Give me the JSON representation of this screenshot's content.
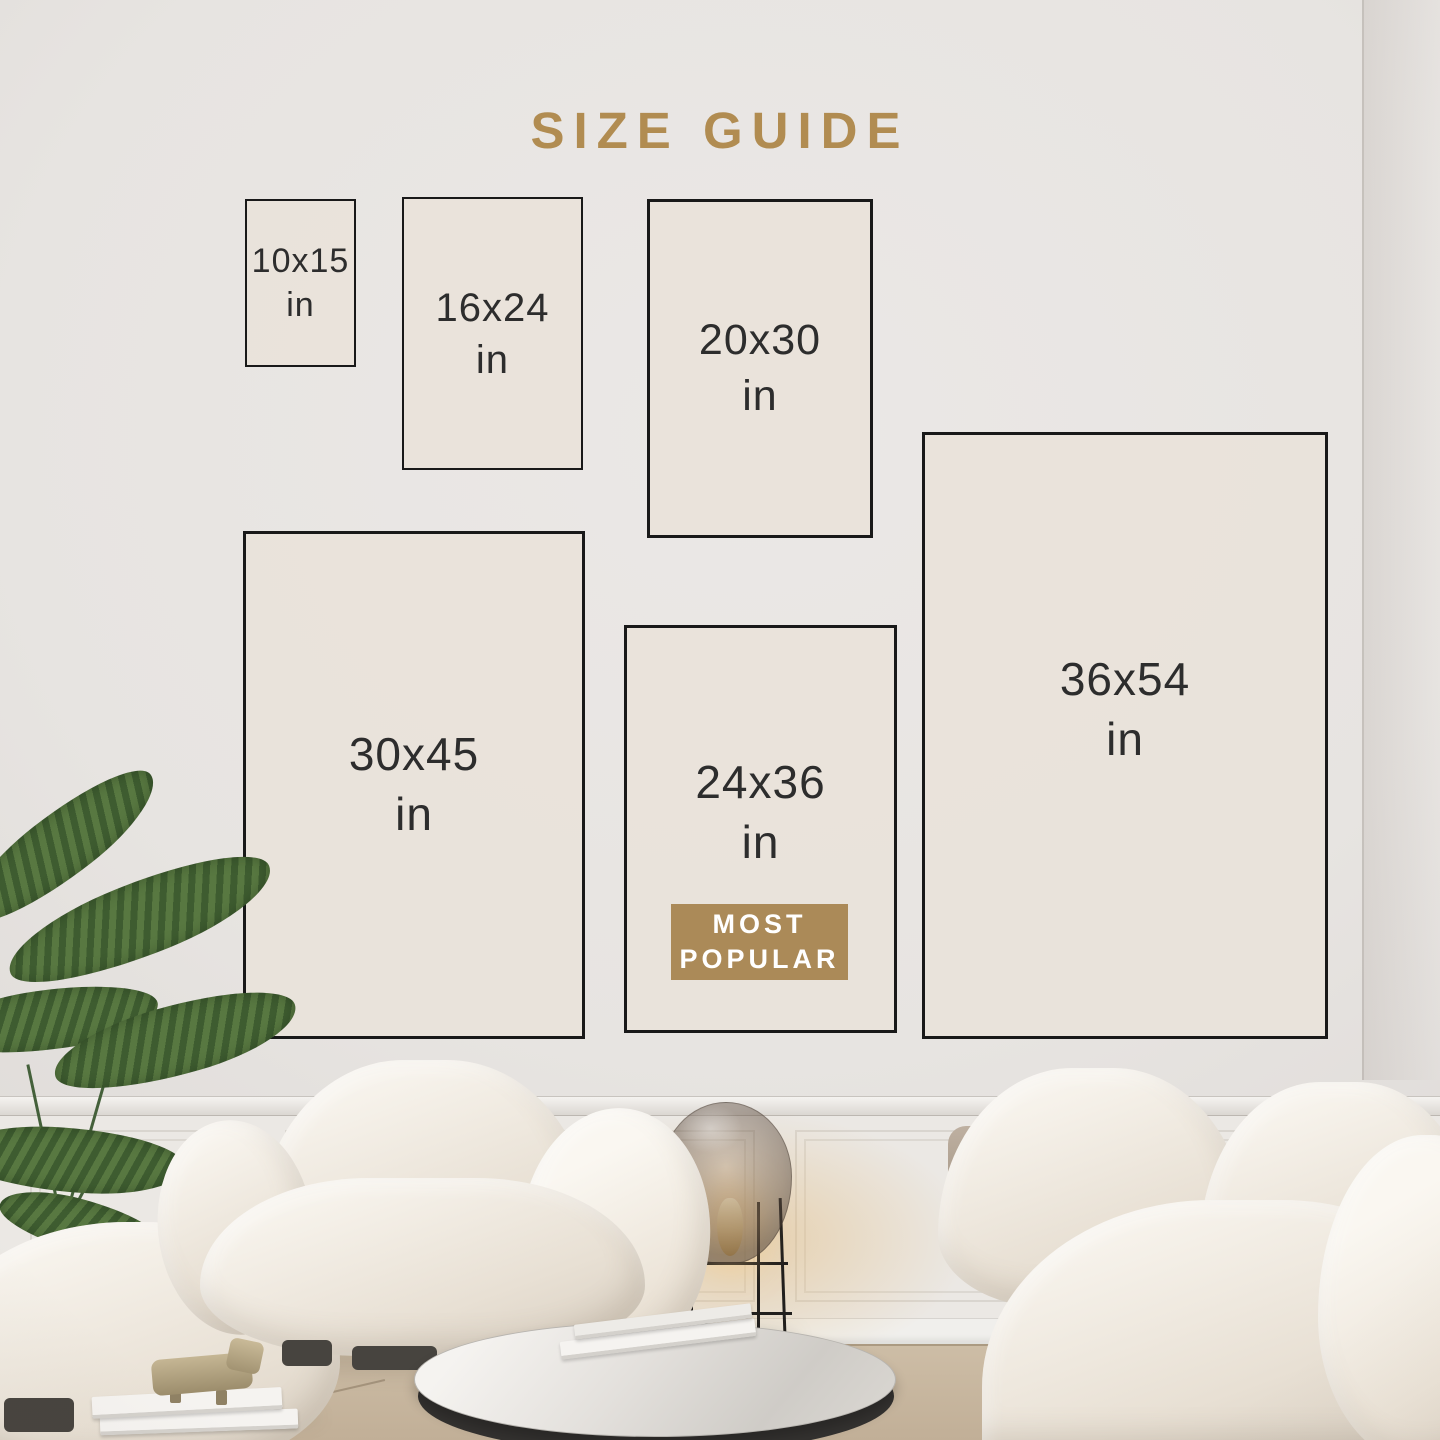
{
  "title": "SIZE GUIDE",
  "sizes": [
    {
      "label": "10x15",
      "unit": "in"
    },
    {
      "label": "16x24",
      "unit": "in"
    },
    {
      "label": "20x30",
      "unit": "in"
    },
    {
      "label": "30x45",
      "unit": "in"
    },
    {
      "label": "24x36",
      "unit": "in",
      "badge_line1": "MOST",
      "badge_line2": "POPULAR",
      "most_popular": true
    },
    {
      "label": "36x54",
      "unit": "in"
    }
  ],
  "colors": {
    "title_gold": "#b18c51",
    "badge_gold": "#ab8a58",
    "badge_text": "#ffffff",
    "frame_border": "#191919",
    "frame_fill": "#e9e3db",
    "label_text": "#2d2d2d"
  }
}
